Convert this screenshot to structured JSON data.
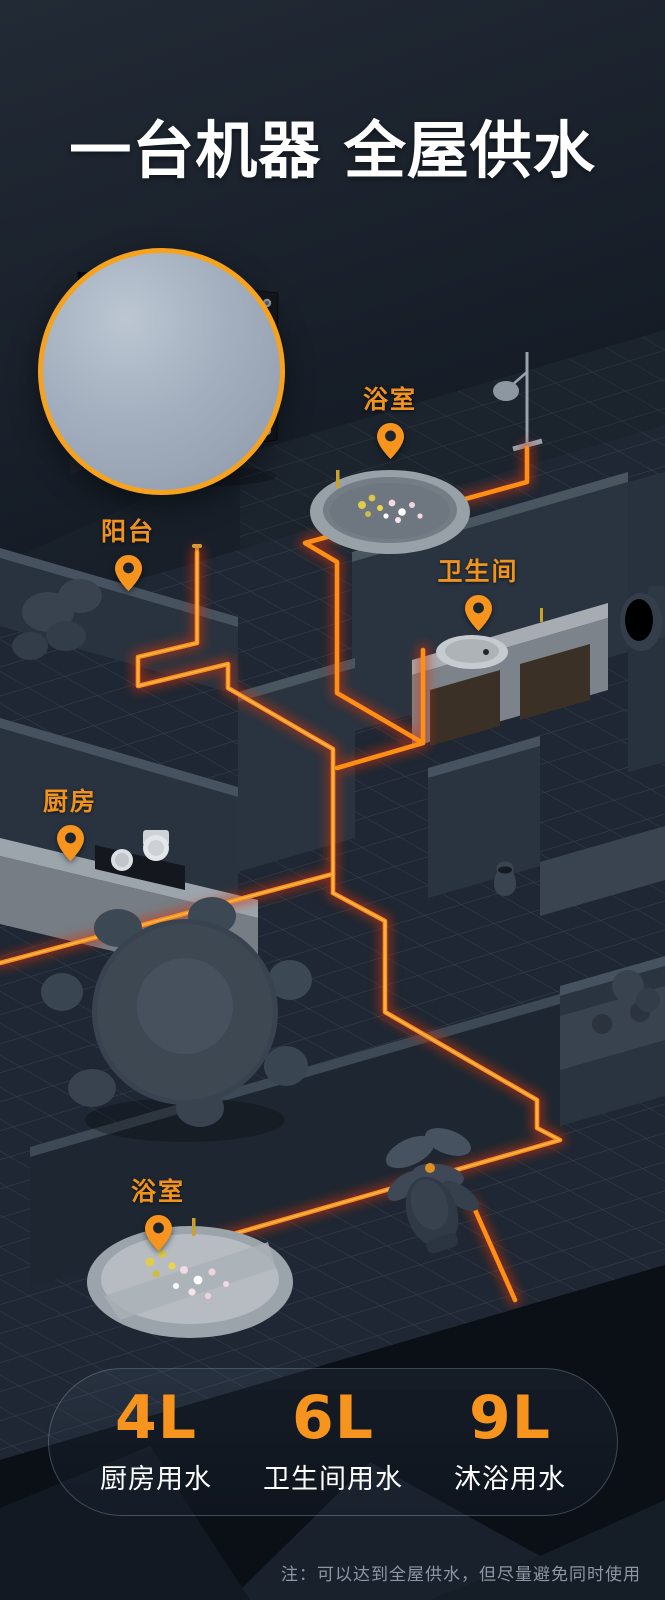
{
  "title": "一台机器 全屋供水",
  "rooms": [
    {
      "id": "bathroom-top",
      "label": "浴室"
    },
    {
      "id": "balcony",
      "label": "阳台"
    },
    {
      "id": "toilet-room",
      "label": "卫生间"
    },
    {
      "id": "kitchen",
      "label": "厨房"
    },
    {
      "id": "bathroom-bottom",
      "label": "浴室"
    }
  ],
  "stats": [
    {
      "value": "4L",
      "label": "厨房用水"
    },
    {
      "value": "6L",
      "label": "卫生间用水"
    },
    {
      "value": "9L",
      "label": "沐浴用水"
    }
  ],
  "footnote": "注：可以达到全屋供水，但尽量避免同时使用",
  "icons": {
    "pin": "location-pin"
  },
  "colors": {
    "accent_orange": "#F7941E",
    "label_orange": "#F0921E",
    "pipe_core": "#FF8E14",
    "pipe_glow": "#D6330A",
    "background_dark": "#10161E",
    "wall_face": "#29333F",
    "wall_top": "#46525F",
    "title_white": "#FFFFFF",
    "note_gray": "#8D97A3",
    "inset_ring": "#F7A21C"
  }
}
